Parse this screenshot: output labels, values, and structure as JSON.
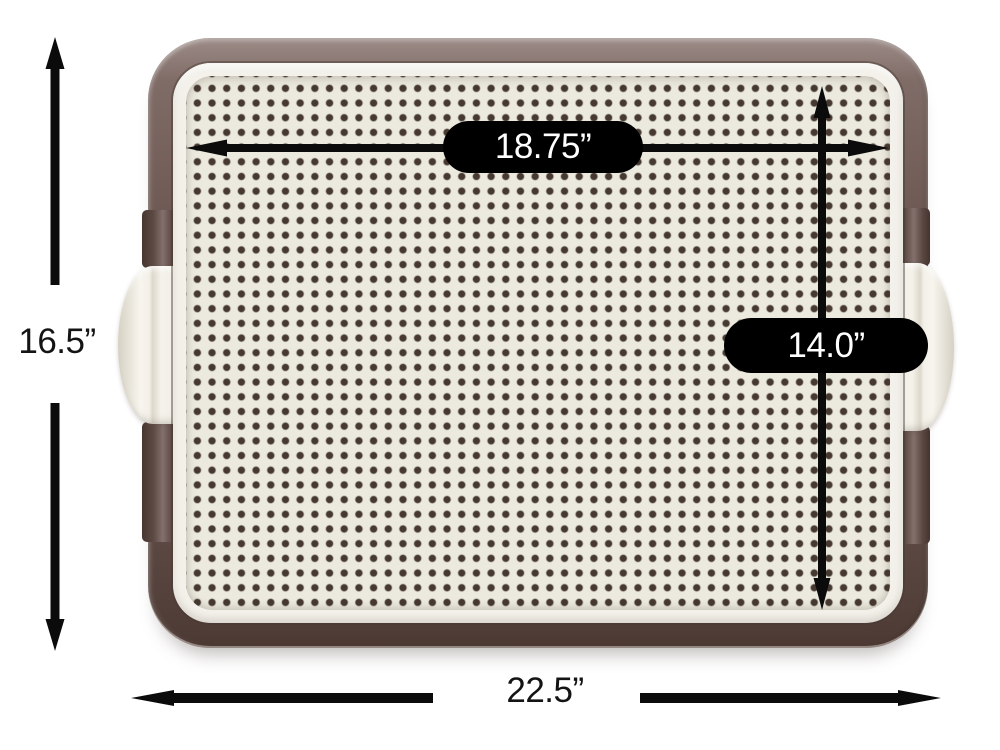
{
  "page": {
    "description": "Dimension diagram of a brown pet training pad holder tray with a perforated off-white grid surface and side latch handles",
    "background": "#ffffff"
  },
  "labels": {
    "outer_height": "16.5”",
    "outer_width": "22.5”",
    "inner_width": "18.75”",
    "inner_height": "14.0”"
  },
  "dimensions": [
    {
      "name": "outer-height",
      "value": "16.5”",
      "orientation": "vertical",
      "position": "left-of-tray",
      "style": "black-arrow-split-by-text"
    },
    {
      "name": "outer-width",
      "value": "22.5”",
      "orientation": "horizontal",
      "position": "below-tray",
      "style": "black-arrow-split-by-text"
    },
    {
      "name": "inner-width",
      "value": "18.75”",
      "orientation": "horizontal",
      "position": "inside-tray-top",
      "style": "black-pill-on-arrow"
    },
    {
      "name": "inner-height",
      "value": "14.0”",
      "orientation": "vertical",
      "position": "inside-tray-right",
      "style": "black-pill-on-arrow"
    }
  ],
  "colors": {
    "frame_brown_light": "#8a7672",
    "frame_brown_dark": "#4c3933",
    "rim_white": "#f3f1ea",
    "grid_surface": "#eceadf",
    "hole_brown": "#463931",
    "pill_background": "#000000",
    "pill_text": "#ffffff",
    "annotation": "#141414"
  }
}
